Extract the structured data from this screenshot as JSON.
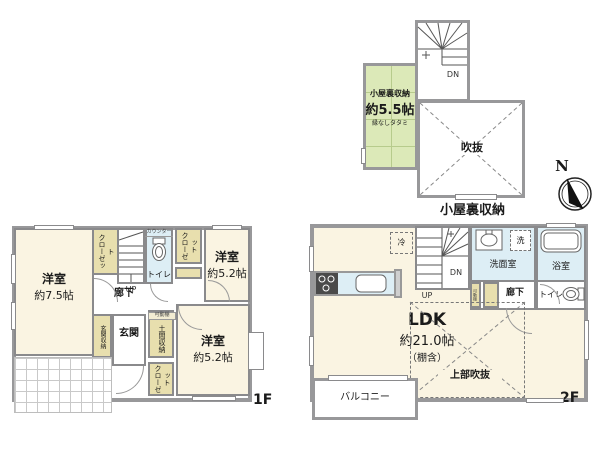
{
  "colors": {
    "wall": "#98989a",
    "room_cream": "#faf4e2",
    "tatami_green": "#dce9b8",
    "closet_tan": "#e8dfae",
    "water_blue": "#ddeef5"
  },
  "compass": {
    "n": "N"
  },
  "attic": {
    "caption": "小屋裏収納",
    "dn": "DN",
    "storage_name": "小屋裏収納",
    "storage_size": "約5.5帖",
    "storage_note": "縁なしタタミ",
    "void": "吹抜"
  },
  "f1": {
    "floor": "1F",
    "room_main_name": "洋室",
    "room_main_size": "約7.5帖",
    "room_tr_name": "洋室",
    "room_tr_size": "約5.2帖",
    "room_br_name": "洋室",
    "room_br_size": "約5.2帖",
    "closet_top": "クローゼット",
    "closet_right": "クローゼット",
    "closet_bottom": "クローゼット",
    "stair_up": "UP",
    "counter": "カウンター",
    "toilet": "トイレ",
    "hall": "廊下",
    "entrance": "玄関",
    "entrance_storage": "玄関収納",
    "movable_shelf": "可動棚",
    "doma_storage": "土間収納"
  },
  "f2": {
    "floor": "2F",
    "fridge": "冷",
    "stair_up": "UP",
    "stair_dn": "DN",
    "washroom": "洗面室",
    "laundry": "洗",
    "bath": "浴室",
    "hall": "廊下",
    "movable_shelf": "可動棚",
    "toilet": "トイレ",
    "ldk_name": "LDK",
    "ldk_size": "約21.0帖",
    "ldk_note": "（棚含）",
    "upper_void": "上部吹抜",
    "balcony": "バルコニー"
  }
}
